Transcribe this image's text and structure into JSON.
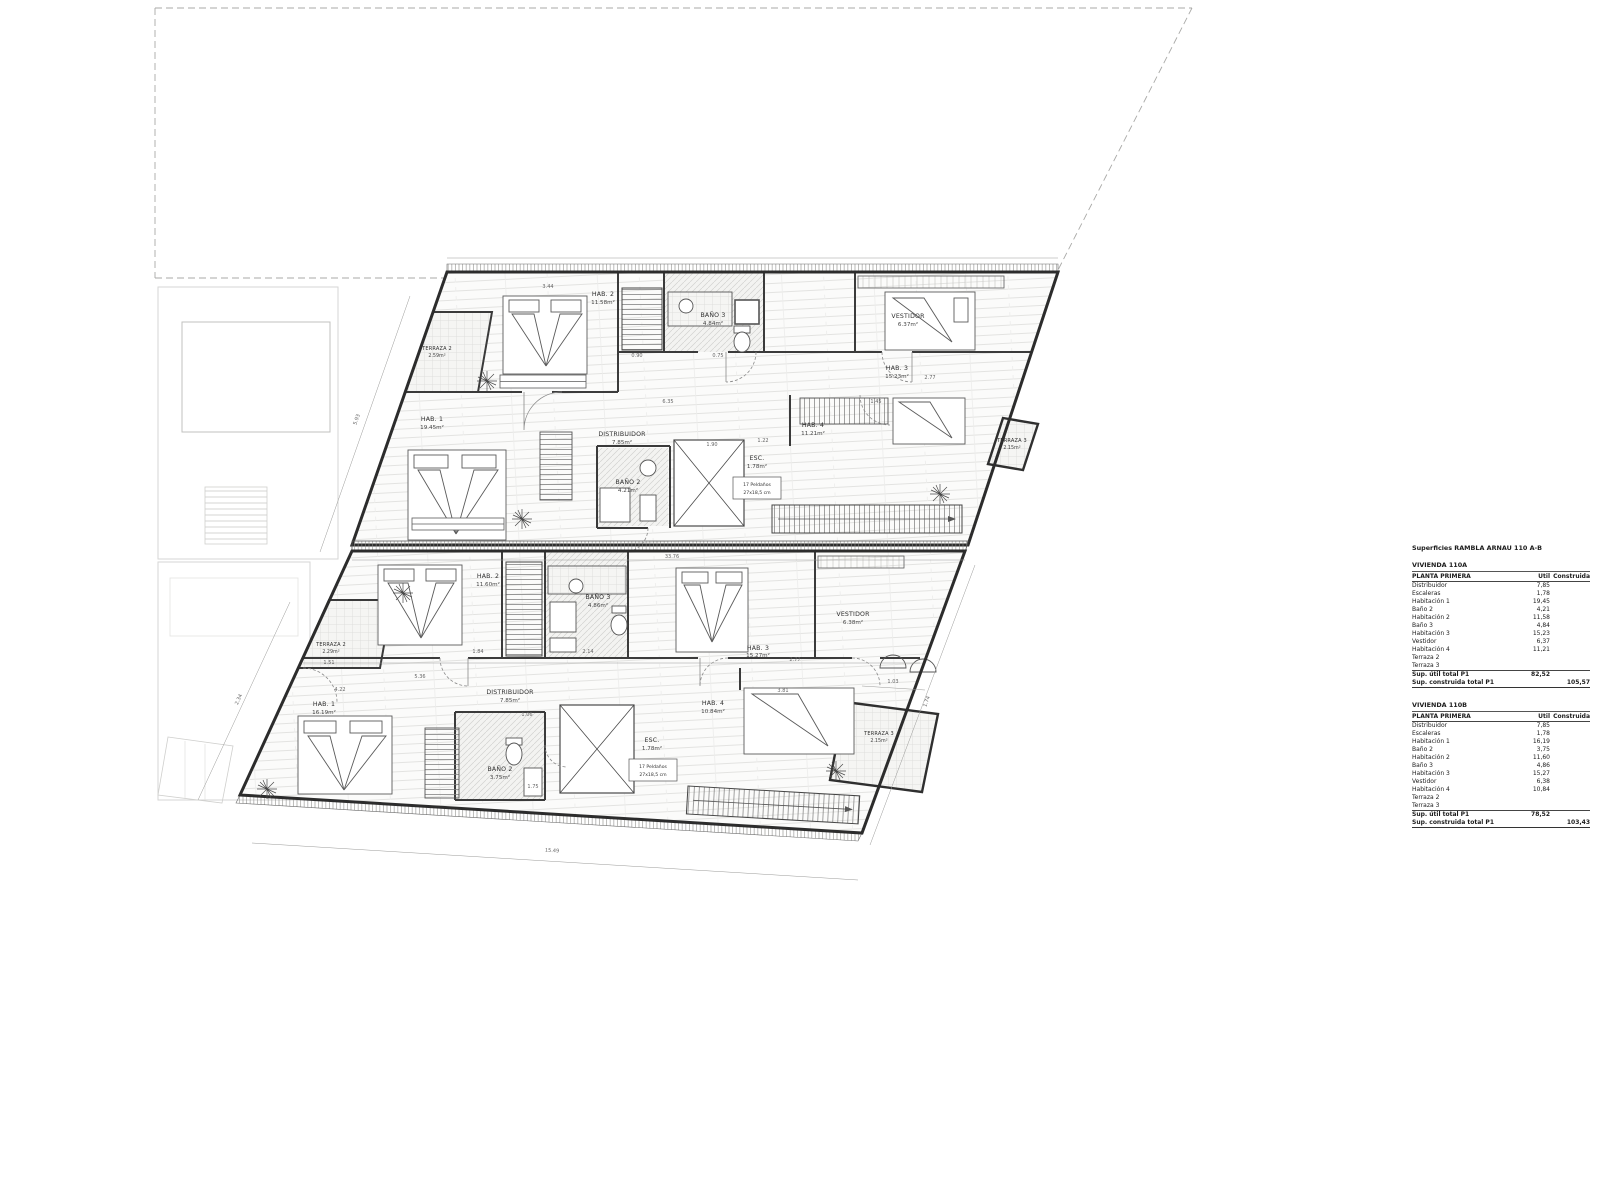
{
  "summary": {
    "title": "Superficies RAMBLA ARNAU 110 A-B",
    "header": {
      "section": "PLANTA PRIMERA",
      "util": "Útil",
      "construida": "Construida"
    },
    "units": [
      {
        "name": "VIVIENDA 110A",
        "rows": [
          [
            "Distribuidor",
            "7,85",
            ""
          ],
          [
            "Escaleras",
            "1,78",
            ""
          ],
          [
            "Habitación 1",
            "19,45",
            ""
          ],
          [
            "Baño 2",
            "4,21",
            ""
          ],
          [
            "Habitación 2",
            "11,58",
            ""
          ],
          [
            "Baño 3",
            "4,84",
            ""
          ],
          [
            "Habitación 3",
            "15,23",
            ""
          ],
          [
            "Vestidor",
            "6,37",
            ""
          ],
          [
            "Habitación 4",
            "11,21",
            ""
          ],
          [
            "Terraza 2",
            "",
            ""
          ],
          [
            "Terraza 3",
            "",
            ""
          ]
        ],
        "totals": [
          [
            "Sup. útil total P1",
            "82,52",
            ""
          ],
          [
            "Sup. construida total P1",
            "",
            "105,57"
          ]
        ]
      },
      {
        "name": "VIVIENDA 110B",
        "rows": [
          [
            "Distribuidor",
            "7,85",
            ""
          ],
          [
            "Escaleras",
            "1,78",
            ""
          ],
          [
            "Habitación 1",
            "16,19",
            ""
          ],
          [
            "Baño 2",
            "3,75",
            ""
          ],
          [
            "Habitación 2",
            "11,60",
            ""
          ],
          [
            "Baño 3",
            "4,86",
            ""
          ],
          [
            "Habitación 3",
            "15,27",
            ""
          ],
          [
            "Vestidor",
            "6,38",
            ""
          ],
          [
            "Habitación 4",
            "10,84",
            ""
          ],
          [
            "Terraza 2",
            "",
            ""
          ],
          [
            "Terraza 3",
            "",
            ""
          ]
        ],
        "totals": [
          [
            "Sup. útil total P1",
            "78,52",
            ""
          ],
          [
            "Sup. construida total P1",
            "",
            "103,43"
          ]
        ]
      }
    ]
  },
  "plan": {
    "rooms": [
      {
        "name": "TERRAZA 2",
        "area": "2.59m²"
      },
      {
        "name": "HAB. 2",
        "area": "11.58m²"
      },
      {
        "name": "BAÑO 3",
        "area": "4.84m²"
      },
      {
        "name": "VESTIDOR",
        "area": "6.37m²"
      },
      {
        "name": "HAB. 3",
        "area": "15.23m²"
      },
      {
        "name": "HAB. 1",
        "area": "19.45m²"
      },
      {
        "name": "DISTRIBUIDOR",
        "area": "7.85m²"
      },
      {
        "name": "HAB. 4",
        "area": "11.21m²"
      },
      {
        "name": "BAÑO 2",
        "area": "4.21m²"
      },
      {
        "name": "ESC.",
        "area": "1.78m²"
      },
      {
        "name": "TERRAZA 3",
        "area": "2.15m²"
      },
      {
        "name": "TERRAZA 2",
        "area": "2.29m²"
      },
      {
        "name": "HAB. 2",
        "area": "11.60m²"
      },
      {
        "name": "BAÑO 3",
        "area": "4.86m²"
      },
      {
        "name": "VESTIDOR",
        "area": "6.38m²"
      },
      {
        "name": "HAB. 3",
        "area": "15.27m²"
      },
      {
        "name": "HAB. 1",
        "area": "16.19m²"
      },
      {
        "name": "DISTRIBUIDOR",
        "area": "7.85m²"
      },
      {
        "name": "HAB. 4",
        "area": "10.84m²"
      },
      {
        "name": "BAÑO 2",
        "area": "3.75m²"
      },
      {
        "name": "ESC.",
        "area": "1.78m²"
      },
      {
        "name": "TERRAZA 3",
        "area": "2.15m²"
      }
    ],
    "stair_note": {
      "l1": "17 Peldaños",
      "l2": "27x18,5 cm"
    },
    "dims": [
      "15.49",
      "33.76",
      "2.77",
      "3.81",
      "5.93",
      "4.22",
      "1.51",
      "0.90",
      "0.75",
      "6.35",
      "1.45",
      "2.77",
      "3.44",
      "1.90",
      "1.22",
      "1.06",
      "1.75",
      "2.14",
      "1.84",
      "5.36",
      "2.34",
      "1.03",
      "1.74"
    ]
  }
}
